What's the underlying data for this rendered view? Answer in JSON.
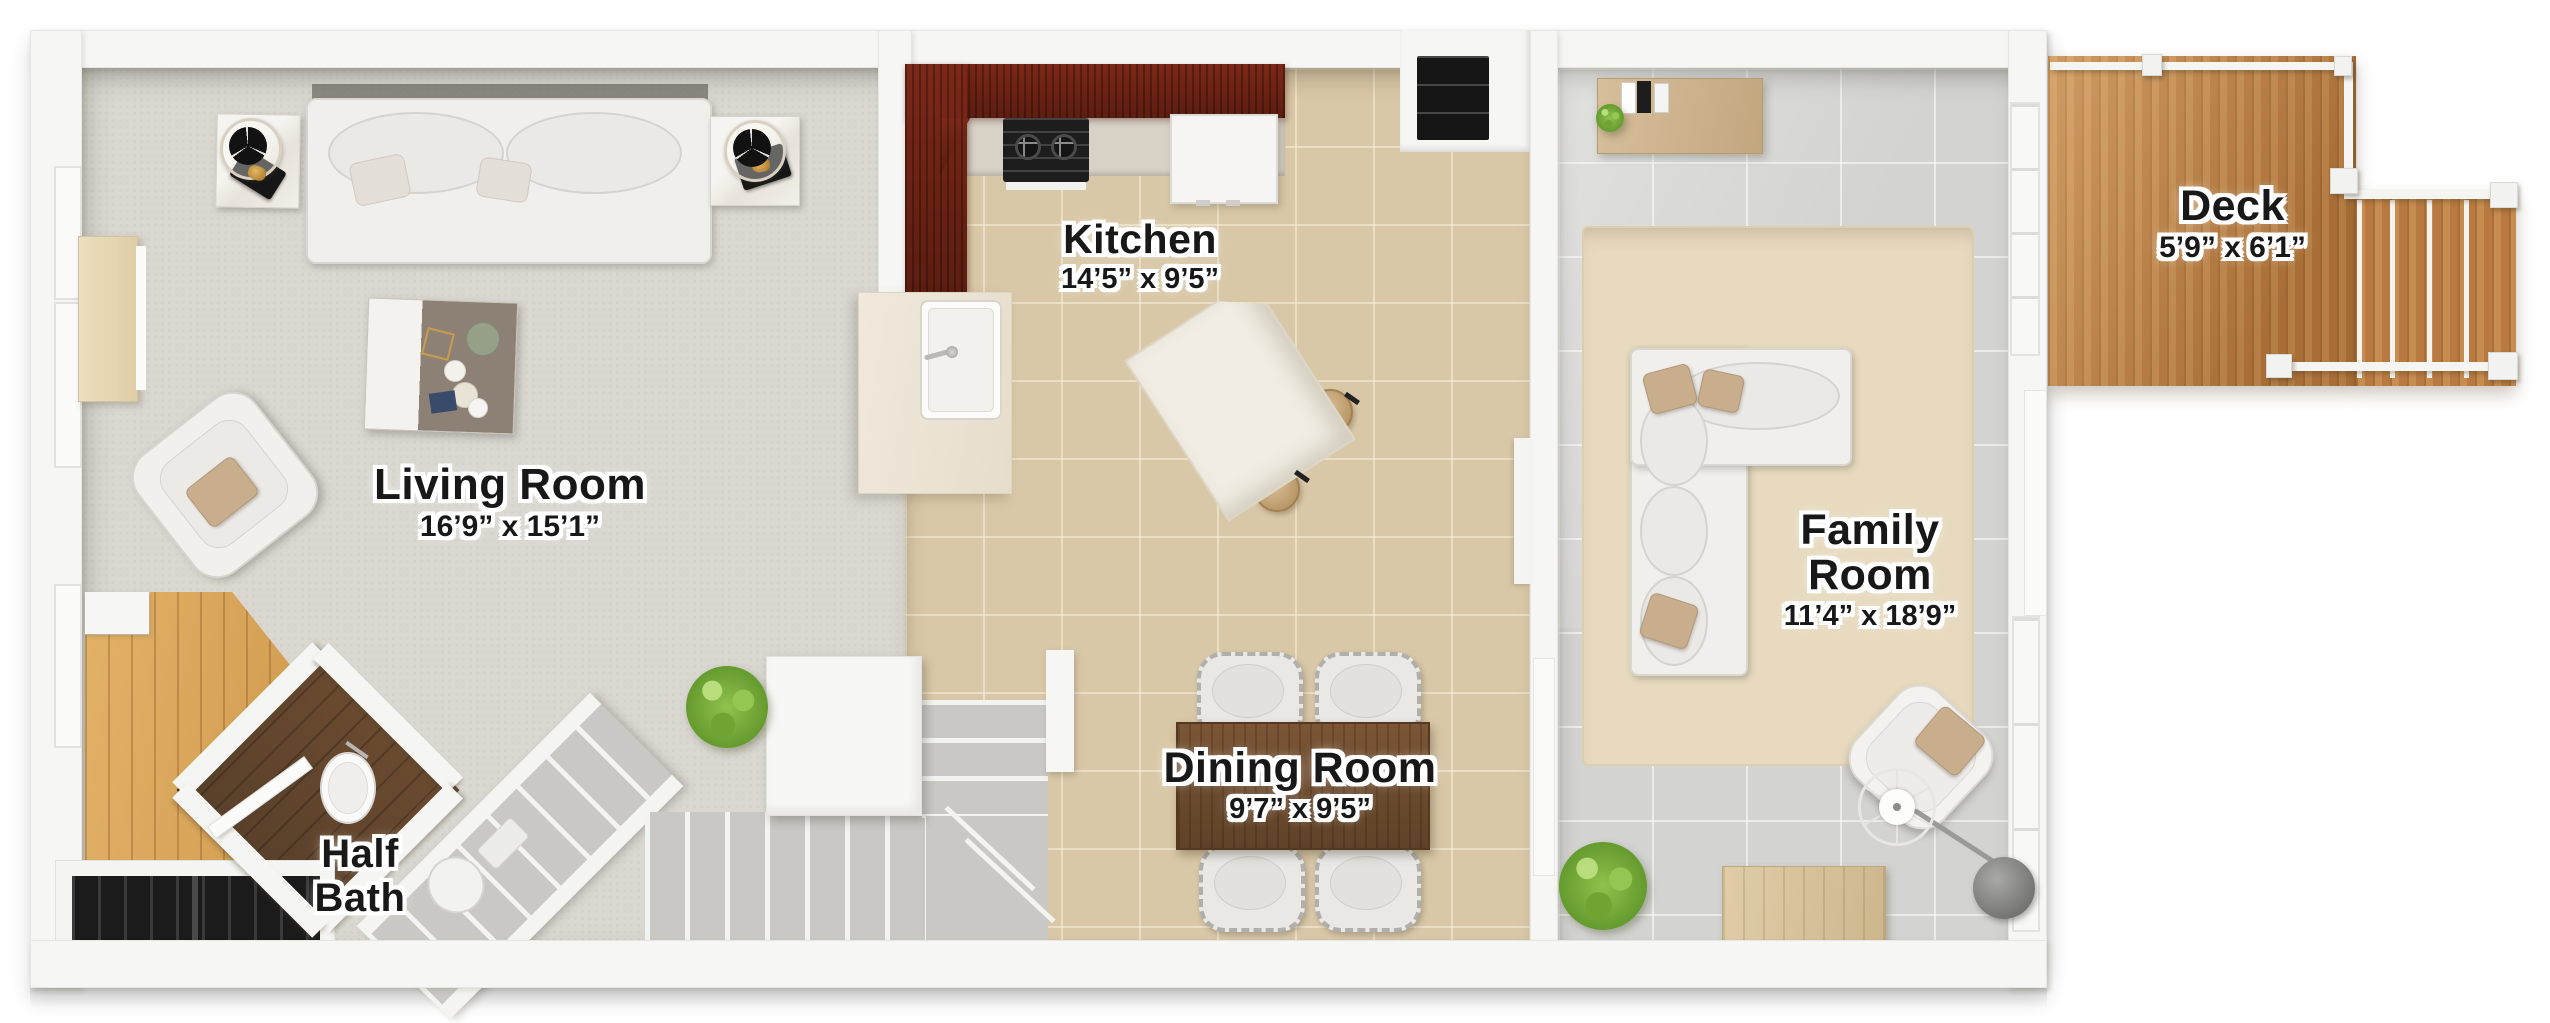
{
  "page": {
    "type": "3d-floor-plan",
    "background": "#ffffff"
  },
  "floorplan": {
    "rooms": [
      {
        "id": "living-room",
        "name": "Living Room",
        "dims": "16’9” x 15’1”"
      },
      {
        "id": "kitchen",
        "name": "Kitchen",
        "dims": "14’5” x 9’5”"
      },
      {
        "id": "dining-room",
        "name": "Dining Room",
        "dims": "9’7” x 9’5”"
      },
      {
        "id": "family-room",
        "lines": [
          "Family",
          "Room"
        ],
        "dims": "11’4” x 18’9”"
      },
      {
        "id": "half-bath",
        "lines": [
          "Half",
          "Bath"
        ]
      },
      {
        "id": "deck",
        "name": "Deck",
        "dims": "5’9” x 6’1”"
      }
    ],
    "colors": {
      "carpet": "#d9d7d0",
      "kitchen_tile": "#d9c8a7",
      "family_tile": "#d3d3d1",
      "deck_wood": "#c08148",
      "entry_wood": "#d9a65c",
      "bath_wood": "#5f4129",
      "counter_cherry": "#6d2114",
      "dining_walnut": "#6f4e31",
      "rug": "#e7dabf",
      "plant_green": "#86b842",
      "wall": "#f6f6f4",
      "appliance_black": "#181818"
    }
  }
}
